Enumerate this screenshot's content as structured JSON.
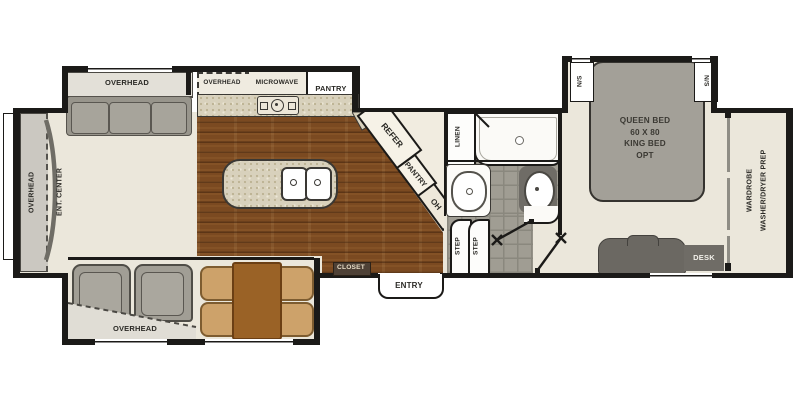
{
  "plan": {
    "front": {
      "overhead": "OVERHEAD",
      "ent_center": "ENT. CENTER"
    },
    "sofa_slide": {
      "overhead": "OVERHEAD"
    },
    "kitchen": {
      "overhead": "OVERHEAD",
      "microwave": "MICROWAVE",
      "pantry": "PANTRY",
      "refer": "REFER",
      "pantry_angled": "PANTRY",
      "oh": "OH"
    },
    "bath": {
      "linen": "LINEN",
      "step_1": "STEP",
      "step_2": "STEP"
    },
    "entry": {
      "closet": "CLOSET",
      "entry": "ENTRY"
    },
    "dinette_slide": {
      "overhead": "OVERHEAD"
    },
    "bedroom": {
      "bed_line1": "QUEEN BED",
      "bed_line2": "60 X 80",
      "bed_line3": "KING BED",
      "bed_line4": "OPT",
      "ns_left": "N/S",
      "ns_right": "N/S",
      "wardrobe": "WARDROBE",
      "washer_dryer": "WASHER/DRYER PREP",
      "desk": "DESK"
    },
    "colors": {
      "wall": "#1b1a18",
      "floor_beige": "#ebe7db",
      "wood_floor": "#7b4a21",
      "tile_gray": "#a09d93",
      "counter_speckle": "#d8d1bc",
      "furniture_gray": "#a19e95",
      "dark_fixture": "#6b6862",
      "closet_bar": "#4e4136",
      "table_brown": "#9a6226",
      "chair_tan": "#cda26a"
    }
  }
}
